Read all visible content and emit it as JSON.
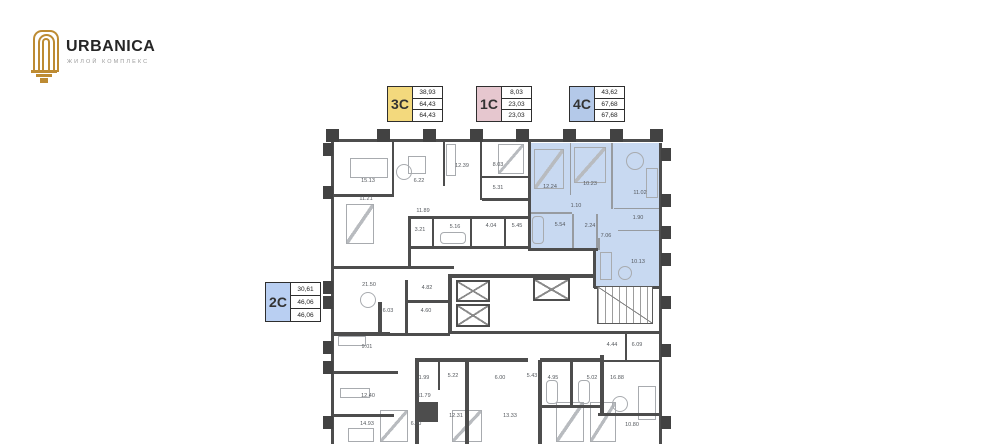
{
  "brand": {
    "name": "URBANICA",
    "tagline": "ЖИЛОЙ КОМПЛЕКС",
    "icon_color": "#bd8b33"
  },
  "legend": [
    {
      "type": "3C",
      "color": "#f3d97d",
      "values": [
        "38,93",
        "64,43",
        "64,43"
      ]
    },
    {
      "type": "1C",
      "color": "#e6c7cf",
      "values": [
        "8,03",
        "23,03",
        "23,03"
      ]
    },
    {
      "type": "4C",
      "color": "#b4c9e9",
      "values": [
        "43,62",
        "67,68",
        "67,68"
      ]
    },
    {
      "type": "2C",
      "color": "#b9cff2",
      "values": [
        "30,61",
        "46,06",
        "46,06"
      ]
    }
  ],
  "floorplan": {
    "wall_color": "#4d4d4d",
    "highlight_color": "#c8d9f1",
    "highlighted_unit": "4C",
    "highlight_regions": [
      [
        530,
        143,
        129,
        106
      ],
      [
        595,
        240,
        65,
        46
      ]
    ],
    "rooms": [
      {
        "a": "15.13",
        "x": 368,
        "y": 181
      },
      {
        "a": "11.21",
        "x": 366,
        "y": 199
      },
      {
        "a": "6.22",
        "x": 419,
        "y": 181
      },
      {
        "a": "12.39",
        "x": 462,
        "y": 166
      },
      {
        "a": "8.03",
        "x": 498,
        "y": 165
      },
      {
        "a": "5.31",
        "x": 498,
        "y": 188
      },
      {
        "a": "11.89",
        "x": 423,
        "y": 211
      },
      {
        "a": "3.21",
        "x": 420,
        "y": 230
      },
      {
        "a": "5.16",
        "x": 455,
        "y": 227
      },
      {
        "a": "4.04",
        "x": 491,
        "y": 226
      },
      {
        "a": "5.45",
        "x": 517,
        "y": 226
      },
      {
        "a": "12.24",
        "x": 550,
        "y": 187
      },
      {
        "a": "10.23",
        "x": 590,
        "y": 184
      },
      {
        "a": "11.02",
        "x": 640,
        "y": 193
      },
      {
        "a": "1.10",
        "x": 576,
        "y": 206
      },
      {
        "a": "5.54",
        "x": 560,
        "y": 225
      },
      {
        "a": "2.24",
        "x": 590,
        "y": 226
      },
      {
        "a": "1.90",
        "x": 638,
        "y": 218
      },
      {
        "a": "7.06",
        "x": 606,
        "y": 236
      },
      {
        "a": "10.13",
        "x": 638,
        "y": 262
      },
      {
        "a": "21.50",
        "x": 369,
        "y": 285
      },
      {
        "a": "4.82",
        "x": 427,
        "y": 288
      },
      {
        "a": "6.03",
        "x": 388,
        "y": 311
      },
      {
        "a": "4.60",
        "x": 426,
        "y": 311
      },
      {
        "a": "9.01",
        "x": 367,
        "y": 347
      },
      {
        "a": "12.40",
        "x": 368,
        "y": 396
      },
      {
        "a": "14.93",
        "x": 367,
        "y": 424
      },
      {
        "a": "6.00",
        "x": 416,
        "y": 424
      },
      {
        "a": "1.99",
        "x": 424,
        "y": 378
      },
      {
        "a": "5.22",
        "x": 453,
        "y": 376
      },
      {
        "a": "11.79",
        "x": 424,
        "y": 396
      },
      {
        "a": "12.31",
        "x": 456,
        "y": 416
      },
      {
        "a": "6.00",
        "x": 500,
        "y": 378
      },
      {
        "a": "5.43",
        "x": 532,
        "y": 376
      },
      {
        "a": "13.33",
        "x": 510,
        "y": 416
      },
      {
        "a": "4.95",
        "x": 553,
        "y": 378
      },
      {
        "a": "5.02",
        "x": 592,
        "y": 378
      },
      {
        "a": "16.88",
        "x": 617,
        "y": 378
      },
      {
        "a": "4.44",
        "x": 612,
        "y": 345
      },
      {
        "a": "6.09",
        "x": 637,
        "y": 345
      },
      {
        "a": "10.80",
        "x": 632,
        "y": 425
      }
    ],
    "walls": [
      [
        332,
        139,
        329,
        3
      ],
      [
        331,
        139,
        3,
        305
      ],
      [
        659,
        143,
        3,
        301
      ],
      [
        528,
        141,
        3,
        110
      ],
      [
        528,
        248,
        70,
        3
      ],
      [
        593,
        250,
        3,
        38
      ],
      [
        594,
        286,
        68,
        3
      ],
      [
        334,
        194,
        60,
        3
      ],
      [
        392,
        142,
        2,
        54
      ],
      [
        443,
        142,
        2,
        44
      ],
      [
        480,
        142,
        2,
        58
      ],
      [
        482,
        176,
        47,
        2
      ],
      [
        482,
        198,
        47,
        3
      ],
      [
        408,
        216,
        121,
        3
      ],
      [
        432,
        218,
        2,
        30
      ],
      [
        470,
        218,
        2,
        30
      ],
      [
        504,
        218,
        2,
        30
      ],
      [
        408,
        246,
        121,
        3
      ],
      [
        408,
        216,
        3,
        52
      ],
      [
        334,
        266,
        120,
        3
      ],
      [
        450,
        274,
        146,
        4
      ],
      [
        448,
        274,
        4,
        60
      ],
      [
        448,
        331,
        214,
        3
      ],
      [
        332,
        332,
        58,
        4
      ],
      [
        378,
        302,
        4,
        34
      ],
      [
        405,
        280,
        3,
        55
      ],
      [
        405,
        300,
        45,
        3
      ],
      [
        378,
        333,
        72,
        3
      ],
      [
        332,
        371,
        66,
        3
      ],
      [
        418,
        358,
        110,
        4
      ],
      [
        540,
        358,
        62,
        4
      ],
      [
        598,
        360,
        64,
        2
      ],
      [
        625,
        334,
        2,
        26
      ],
      [
        438,
        360,
        2,
        30
      ],
      [
        465,
        360,
        4,
        84
      ],
      [
        538,
        360,
        4,
        84
      ],
      [
        600,
        355,
        4,
        60
      ],
      [
        570,
        360,
        3,
        46
      ],
      [
        540,
        405,
        62,
        3
      ],
      [
        598,
        413,
        64,
        3
      ],
      [
        415,
        358,
        4,
        86
      ],
      [
        332,
        414,
        62,
        3
      ],
      [
        416,
        402,
        22,
        20
      ]
    ],
    "partitions": [
      [
        570,
        143,
        1,
        52
      ],
      [
        611,
        143,
        2,
        66
      ],
      [
        530,
        212,
        42,
        2
      ],
      [
        572,
        214,
        2,
        36
      ],
      [
        596,
        214,
        2,
        34
      ],
      [
        614,
        208,
        46,
        1
      ],
      [
        618,
        230,
        42,
        1
      ],
      [
        598,
        238,
        2,
        12
      ]
    ],
    "stubs": [
      [
        326,
        129,
        13,
        13
      ],
      [
        377,
        129,
        13,
        13
      ],
      [
        423,
        129,
        13,
        13
      ],
      [
        470,
        129,
        13,
        13
      ],
      [
        516,
        129,
        13,
        13
      ],
      [
        563,
        129,
        13,
        13
      ],
      [
        610,
        129,
        13,
        13
      ],
      [
        650,
        129,
        13,
        13
      ],
      [
        323,
        143,
        10,
        13
      ],
      [
        323,
        186,
        10,
        13
      ],
      [
        323,
        281,
        10,
        13
      ],
      [
        323,
        296,
        10,
        13
      ],
      [
        323,
        341,
        10,
        13
      ],
      [
        323,
        361,
        10,
        13
      ],
      [
        323,
        416,
        10,
        13
      ],
      [
        661,
        148,
        10,
        13
      ],
      [
        661,
        194,
        10,
        13
      ],
      [
        661,
        226,
        10,
        13
      ],
      [
        661,
        253,
        10,
        13
      ],
      [
        661,
        296,
        10,
        13
      ],
      [
        661,
        344,
        10,
        13
      ],
      [
        661,
        416,
        10,
        13
      ]
    ],
    "elevators": [
      [
        456,
        280,
        34,
        22
      ],
      [
        456,
        304,
        34,
        23
      ],
      [
        533,
        278,
        37,
        23
      ]
    ],
    "stairs": [
      597,
      286,
      56,
      38
    ],
    "furniture": [
      {
        "t": "rect",
        "x": 350,
        "y": 158,
        "w": 38,
        "h": 20
      },
      {
        "t": "circle",
        "x": 396,
        "y": 164,
        "w": 16,
        "h": 16
      },
      {
        "t": "rect",
        "x": 408,
        "y": 156,
        "w": 18,
        "h": 18
      },
      {
        "t": "bed",
        "x": 346,
        "y": 204,
        "w": 28,
        "h": 40
      },
      {
        "t": "rect",
        "x": 446,
        "y": 144,
        "w": 10,
        "h": 32
      },
      {
        "t": "bed",
        "x": 498,
        "y": 144,
        "w": 26,
        "h": 30
      },
      {
        "t": "bed",
        "x": 534,
        "y": 149,
        "w": 30,
        "h": 40
      },
      {
        "t": "bed",
        "x": 574,
        "y": 147,
        "w": 32,
        "h": 36
      },
      {
        "t": "circle",
        "x": 626,
        "y": 152,
        "w": 18,
        "h": 18
      },
      {
        "t": "rect",
        "x": 646,
        "y": 168,
        "w": 12,
        "h": 30
      },
      {
        "t": "tub",
        "x": 532,
        "y": 216,
        "w": 12,
        "h": 28
      },
      {
        "t": "rect",
        "x": 600,
        "y": 252,
        "w": 12,
        "h": 28
      },
      {
        "t": "circle",
        "x": 618,
        "y": 266,
        "w": 14,
        "h": 14
      },
      {
        "t": "circle",
        "x": 360,
        "y": 292,
        "w": 16,
        "h": 16
      },
      {
        "t": "rect",
        "x": 338,
        "y": 336,
        "w": 28,
        "h": 10
      },
      {
        "t": "rect",
        "x": 340,
        "y": 388,
        "w": 30,
        "h": 10
      },
      {
        "t": "rect",
        "x": 348,
        "y": 428,
        "w": 26,
        "h": 14
      },
      {
        "t": "bed",
        "x": 380,
        "y": 410,
        "w": 28,
        "h": 32
      },
      {
        "t": "bed",
        "x": 452,
        "y": 410,
        "w": 30,
        "h": 32
      },
      {
        "t": "bed",
        "x": 556,
        "y": 402,
        "w": 28,
        "h": 40
      },
      {
        "t": "bed",
        "x": 590,
        "y": 402,
        "w": 26,
        "h": 40
      },
      {
        "t": "tub",
        "x": 440,
        "y": 232,
        "w": 26,
        "h": 12
      },
      {
        "t": "tub",
        "x": 546,
        "y": 380,
        "w": 12,
        "h": 24
      },
      {
        "t": "tub",
        "x": 578,
        "y": 380,
        "w": 12,
        "h": 24
      },
      {
        "t": "rect",
        "x": 638,
        "y": 386,
        "w": 18,
        "h": 34
      },
      {
        "t": "circle",
        "x": 612,
        "y": 396,
        "w": 16,
        "h": 16
      }
    ]
  }
}
